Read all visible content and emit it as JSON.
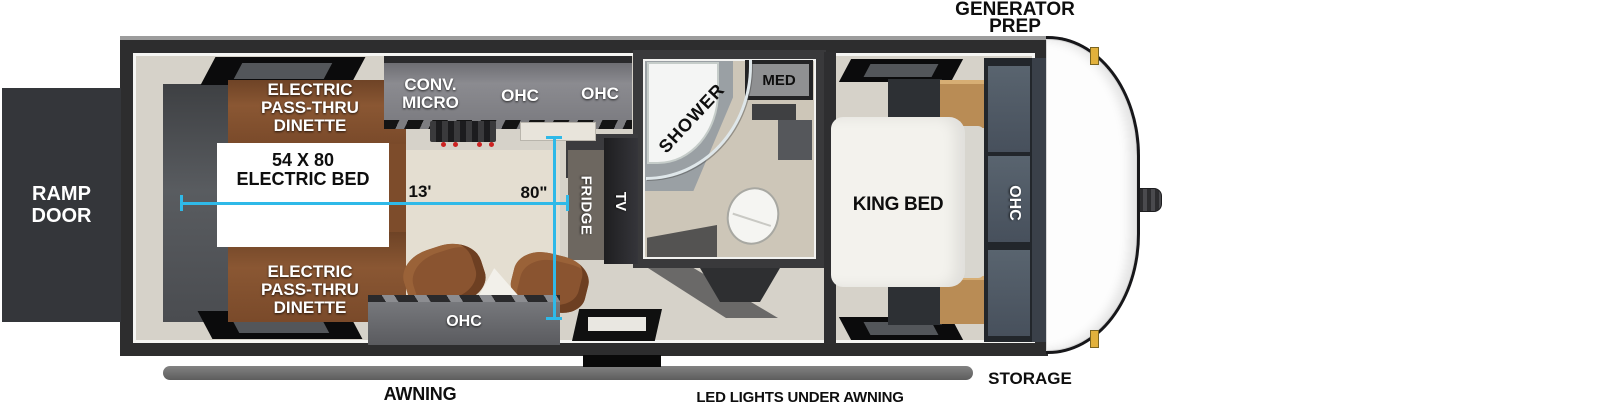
{
  "exterior": {
    "ramp_door": {
      "l1": "RAMP",
      "l2": "DOOR"
    },
    "generator_prep": {
      "l1": "GENERATOR",
      "l2": "PREP"
    },
    "storage": "STORAGE",
    "awning": "AWNING",
    "led_lights": "LED LIGHTS UNDER AWNING"
  },
  "garage": {
    "dinette_top": {
      "l1": "ELECTRIC",
      "l2": "PASS-THRU",
      "l3": "DINETTE"
    },
    "dinette_bottom": {
      "l1": "ELECTRIC",
      "l2": "PASS-THRU",
      "l3": "DINETTE"
    },
    "electric_bed": {
      "l1": "54 X 80",
      "l2": "ELECTRIC BED"
    },
    "ohc_rear": "OHC"
  },
  "kitchen": {
    "conv_micro": {
      "l1": "CONV.",
      "l2": "MICRO"
    },
    "ohc_1": "OHC",
    "ohc_2": "OHC",
    "fridge": "FRIDGE",
    "tv": "TV"
  },
  "dimensions": {
    "garage_length": "13'",
    "bed_width": "80\""
  },
  "bathroom": {
    "shower": "SHOWER",
    "med": "MED"
  },
  "bedroom": {
    "king_bed": "KING BED",
    "ohc": "OHC"
  },
  "colors": {
    "dimension_line": "#2fb9e8",
    "wood": "#8a5733",
    "wall": "#2d2d2e",
    "floor": "#d6d2c9",
    "awning_bar": "#6e6e6e",
    "ramp_door": "#34363a",
    "clearance_light": "#e2b13c",
    "label_white": "#ffffff",
    "label_black": "#0e0e0e"
  }
}
